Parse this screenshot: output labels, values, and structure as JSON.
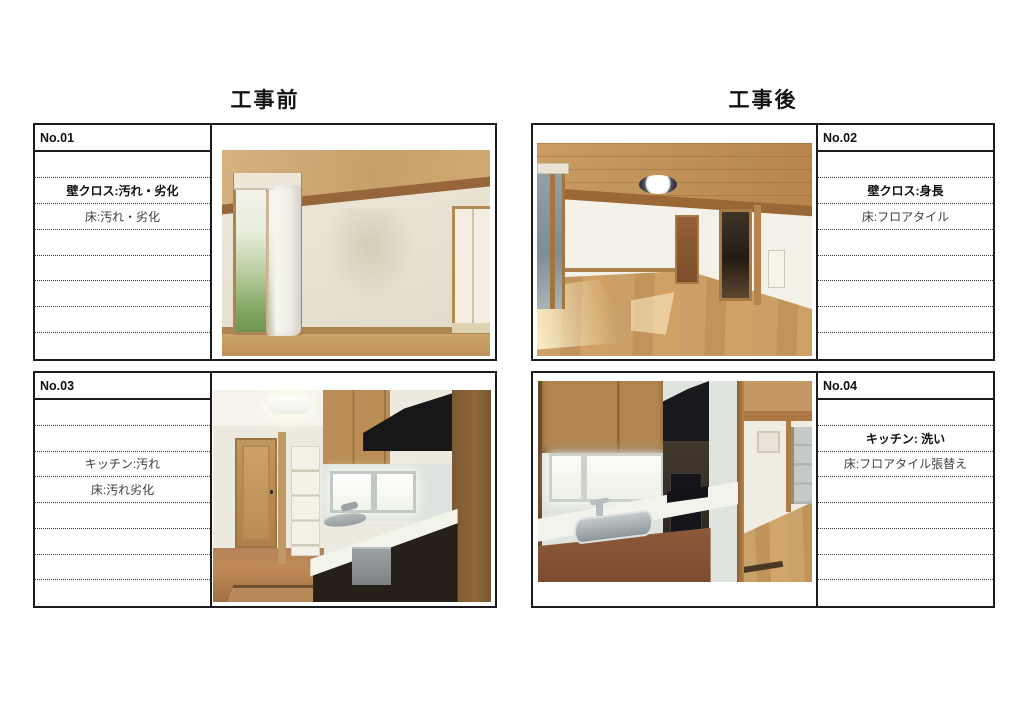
{
  "page": {
    "before_title": "工事前",
    "after_title": "工事後"
  },
  "colors": {
    "ink": "#1a1a1a",
    "paper": "#ffffff"
  },
  "panels": [
    {
      "no": "No.01",
      "side": "before",
      "photo": "living-room-before",
      "rows": [
        "",
        "壁クロス:汚れ・劣化",
        "床:汚れ・劣化",
        "",
        "",
        "",
        "",
        ""
      ]
    },
    {
      "no": "No.02",
      "side": "after",
      "photo": "living-room-after",
      "rows": [
        "",
        "壁クロス:身長",
        "床:フロアタイル",
        "",
        "",
        "",
        "",
        ""
      ]
    },
    {
      "no": "No.03",
      "side": "before",
      "photo": "kitchen-before",
      "rows": [
        "",
        "",
        "キッチン:汚れ",
        "床:汚れ劣化",
        "",
        "",
        "",
        ""
      ]
    },
    {
      "no": "No.04",
      "side": "after",
      "photo": "kitchen-after",
      "rows": [
        "",
        "キッチン: 洗い",
        "床:フロアタイル張替え",
        "",
        "",
        "",
        "",
        ""
      ]
    }
  ]
}
